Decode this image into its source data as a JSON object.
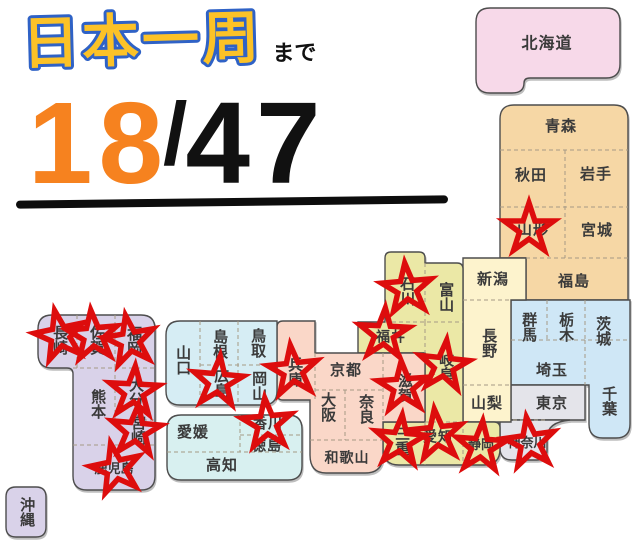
{
  "title": {
    "main": "日本一周",
    "suffix": "まで"
  },
  "counter": {
    "visited": "18",
    "separator": "/",
    "total": "47"
  },
  "colors": {
    "star": "#dd0d0d",
    "title_fill": "#fcc227",
    "title_outline": "#2f62c6",
    "counter_visited": "#f6821f",
    "counter_total": "#111111",
    "regions": {
      "hokkaido": "#f7d9e9",
      "tohoku": "#f6d7a5",
      "kanto": "#cfe7f6",
      "tokyo_kanagawa": "#e4e4ea",
      "koshinetsu": "#fdf3cd",
      "hokuriku_tokai": "#ebe8a6",
      "kansai": "#fad7c8",
      "chugoku": "#d6edf4",
      "shikoku": "#d8f0f0",
      "kyushu": "#d9d2e9",
      "okinawa": "#d9d2e9"
    }
  },
  "prefectures": {
    "hokkaido": "北海道",
    "aomori": "青森",
    "akita": "秋田",
    "iwate": "岩手",
    "yamagata": "山形",
    "miyagi": "宮城",
    "fukushima": "福島",
    "niigata": "新潟",
    "gunma": "群馬",
    "tochigi": "栃木",
    "ibaraki": "茨城",
    "saitama": "埼玉",
    "chiba": "千葉",
    "tokyo": "東京",
    "kanagawa": "神奈川",
    "yamanashi": "山梨",
    "nagano": "長野",
    "toyama": "富山",
    "ishikawa": "石川",
    "fukui": "福井",
    "gifu": "岐阜",
    "shizuoka": "静岡",
    "aichi": "愛知",
    "mie": "三重",
    "shiga": "滋賀",
    "kyoto": "京都",
    "osaka": "大阪",
    "nara": "奈良",
    "wakayama": "和歌山",
    "hyogo": "兵庫",
    "tottori": "鳥取",
    "shimane": "島根",
    "okayama": "岡山",
    "hiroshima": "広島",
    "yamaguchi": "山口",
    "kagawa": "香川",
    "ehime": "愛媛",
    "tokushima": "徳島",
    "kochi": "高知",
    "fukuoka": "福岡",
    "saga": "佐賀",
    "nagasaki": "長崎",
    "kumamoto": "熊本",
    "oita": "大分",
    "miyazaki": "宮崎",
    "kagoshima": "鹿児島",
    "okinawa": "沖縄"
  },
  "visited": [
    "yamagata",
    "ishikawa",
    "fukui",
    "gifu",
    "shiga",
    "mie",
    "aichi",
    "shizuoka",
    "kanagawa",
    "hyogo",
    "hiroshima",
    "kagawa",
    "fukuoka",
    "saga",
    "nagasaki",
    "oita",
    "miyazaki",
    "kagoshima"
  ]
}
